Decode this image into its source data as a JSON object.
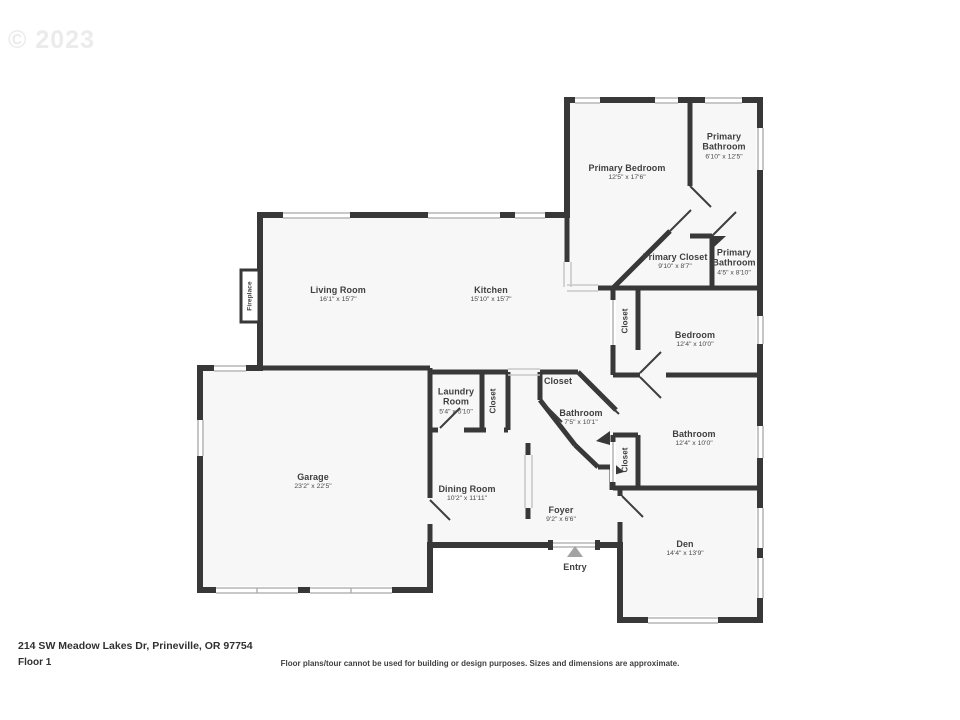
{
  "watermark": "© 2023",
  "rooms": [
    {
      "id": "primary-bedroom",
      "name": "Primary Bedroom",
      "dims": "12'5\" x 17'6\""
    },
    {
      "id": "primary-bathroom-upper",
      "name": "Primary Bathroom",
      "dims": "6'10\" x 12'5\""
    },
    {
      "id": "primary-closet",
      "name": "Primary Closet",
      "dims": "9'10\" x 8'7\""
    },
    {
      "id": "primary-bathroom-lower",
      "name": "Primary Bathroom",
      "dims": "4'5\" x 8'10\""
    },
    {
      "id": "living-room",
      "name": "Living Room",
      "dims": "16'1\" x 15'7\""
    },
    {
      "id": "kitchen",
      "name": "Kitchen",
      "dims": "15'10\" x 15'7\""
    },
    {
      "id": "closet-hall-upper",
      "name": "Closet"
    },
    {
      "id": "bedroom",
      "name": "Bedroom",
      "dims": "12'4\" x 10'0\""
    },
    {
      "id": "laundry-room",
      "name": "Laundry Room",
      "dims": "5'4\" x 5'10\""
    },
    {
      "id": "closet-laundry",
      "name": "Closet"
    },
    {
      "id": "closet-hall-small",
      "name": "Closet"
    },
    {
      "id": "bathroom-hall",
      "name": "Bathroom",
      "dims": "7'5\" x 10'1\""
    },
    {
      "id": "bathroom-main",
      "name": "Bathroom",
      "dims": "12'4\" x 10'0\""
    },
    {
      "id": "closet-bath",
      "name": "Closet"
    },
    {
      "id": "garage",
      "name": "Garage",
      "dims": "23'2\" x 22'5\""
    },
    {
      "id": "dining-room",
      "name": "Dining Room",
      "dims": "10'2\" x 11'11\""
    },
    {
      "id": "foyer",
      "name": "Foyer",
      "dims": "9'2\" x 6'6\""
    },
    {
      "id": "den",
      "name": "Den",
      "dims": "14'4\" x 13'9\""
    },
    {
      "id": "fireplace",
      "name": "Fireplace"
    },
    {
      "id": "entry",
      "name": "Entry"
    }
  ],
  "footer": {
    "address": "214 SW Meadow Lakes Dr, Prineville, OR 97754",
    "floor": "Floor 1",
    "disclaimer": "Floor plans/tour cannot be used for building or design purposes. Sizes and dimensions are approximate."
  },
  "colors": {
    "wall": "#383838",
    "floor": "#f7f7f7",
    "background": "#ffffff",
    "label": "#3f3f3f"
  }
}
